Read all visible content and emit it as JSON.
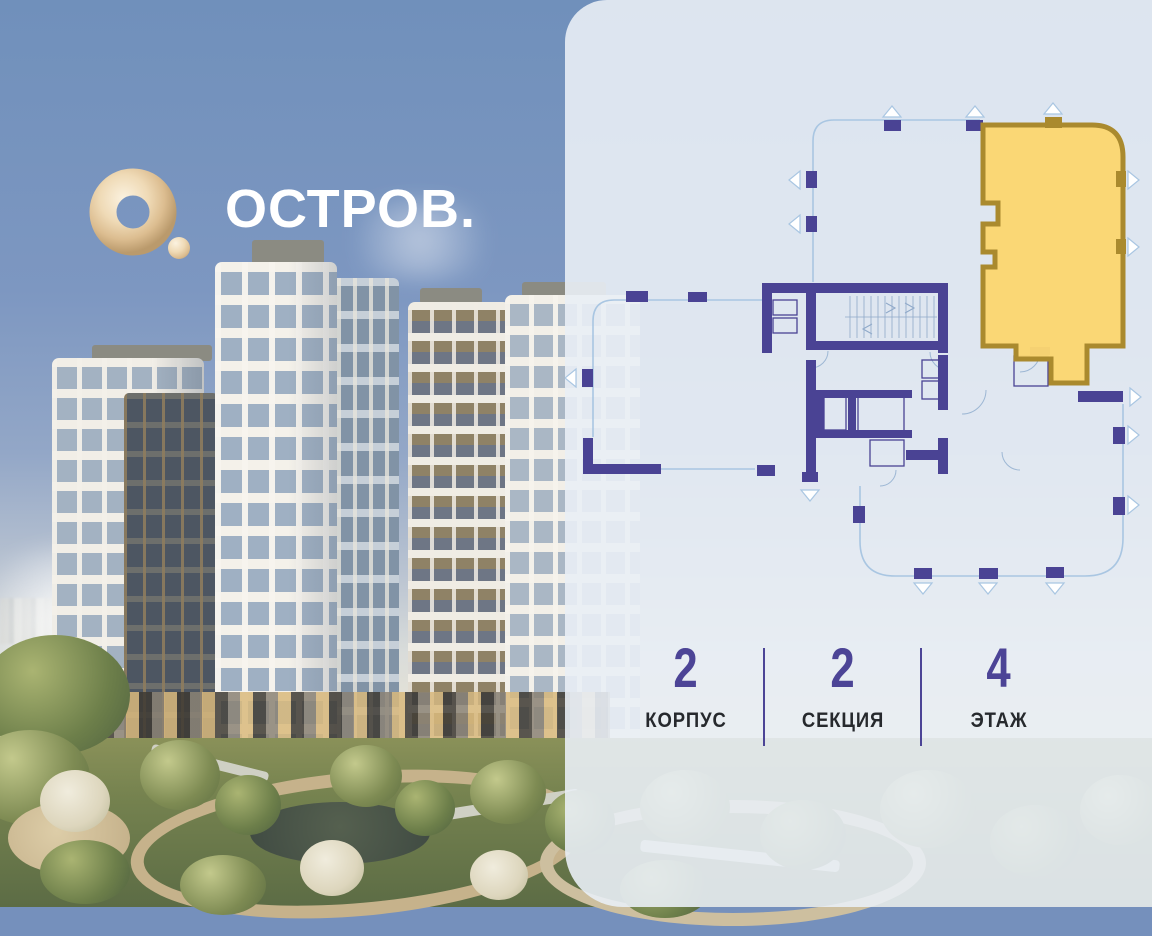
{
  "brand": {
    "name": "ОСТРОВ.",
    "mark": "gold-torus-icon",
    "text_color": "#ffffff"
  },
  "panel": {
    "background": "rgba(233,238,245,0.9)",
    "accent_color": "#4c4496",
    "stats": {
      "items": [
        {
          "value": "2",
          "label": "КОРПУС"
        },
        {
          "value": "2",
          "label": "СЕКЦИЯ"
        },
        {
          "value": "4",
          "label": "ЭТАЖ"
        }
      ]
    },
    "floorplan": {
      "colors": {
        "walls": "#4a4394",
        "outline": "#a9c6e2",
        "highlight_fill": "#fbd671",
        "highlight_wall": "#aa8a2e"
      }
    }
  }
}
